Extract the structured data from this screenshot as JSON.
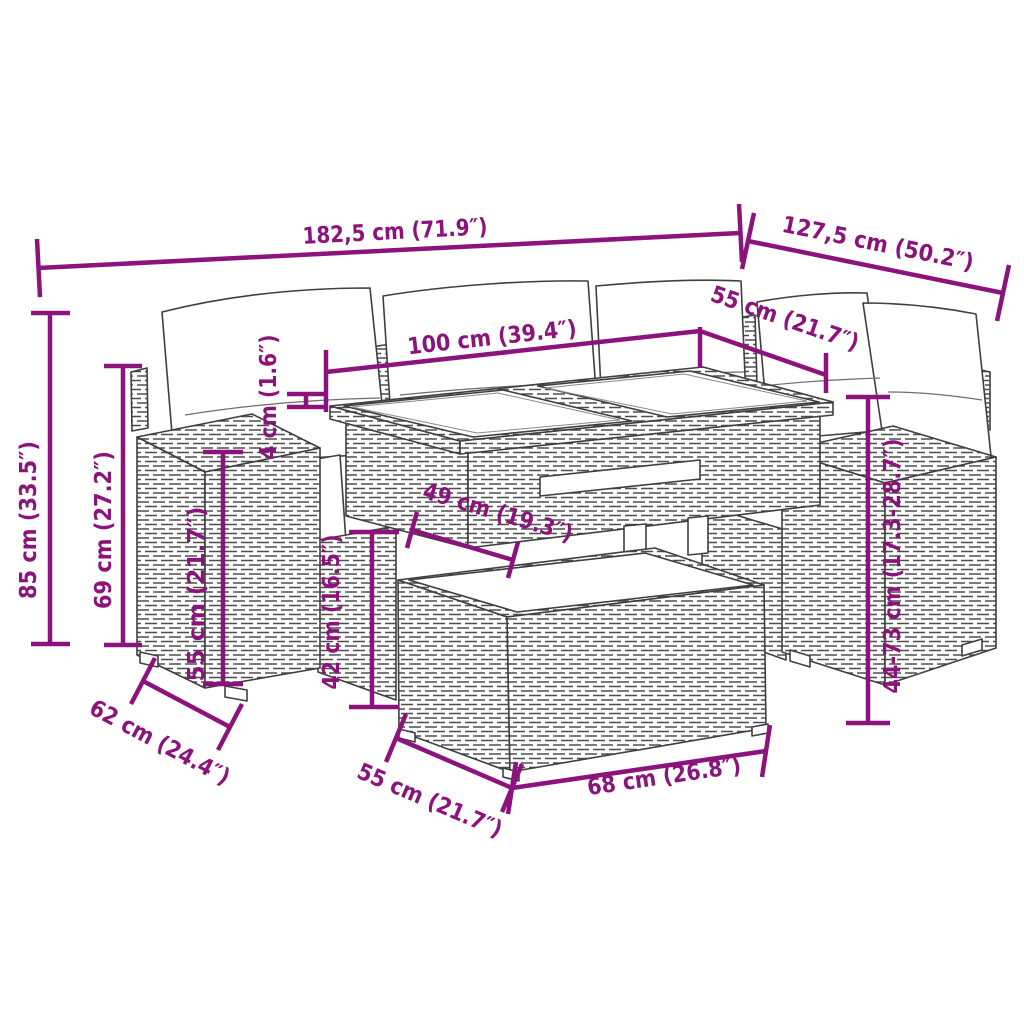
{
  "colors": {
    "dimension_accent": "#8C127C",
    "line_art": "#3f3f3f",
    "background": "#ffffff"
  },
  "dimensions": {
    "overall_width": "182,5 cm (71.9″)",
    "right_section_width": "127,5 cm (50.2″)",
    "table_length": "100 cm (39.4″)",
    "table_depth": "55 cm (21.7″)",
    "overall_height": "85 cm (33.5″)",
    "backrest_height": "69 cm (27.2″)",
    "armrest_height": "55 cm (21.7″)",
    "tabletop_thickness": "4 cm (1.6″)",
    "under_table_clearance": "49 cm (19.3″)",
    "ottoman_height": "42 cm (16.5″)",
    "seat_depth": "62 cm (24.4″)",
    "ottoman_depth": "55 cm (21.7″)",
    "ottoman_width": "68 cm (26.8″)",
    "table_height_adjustable": "44-73 cm (17.3-28.7″)"
  }
}
